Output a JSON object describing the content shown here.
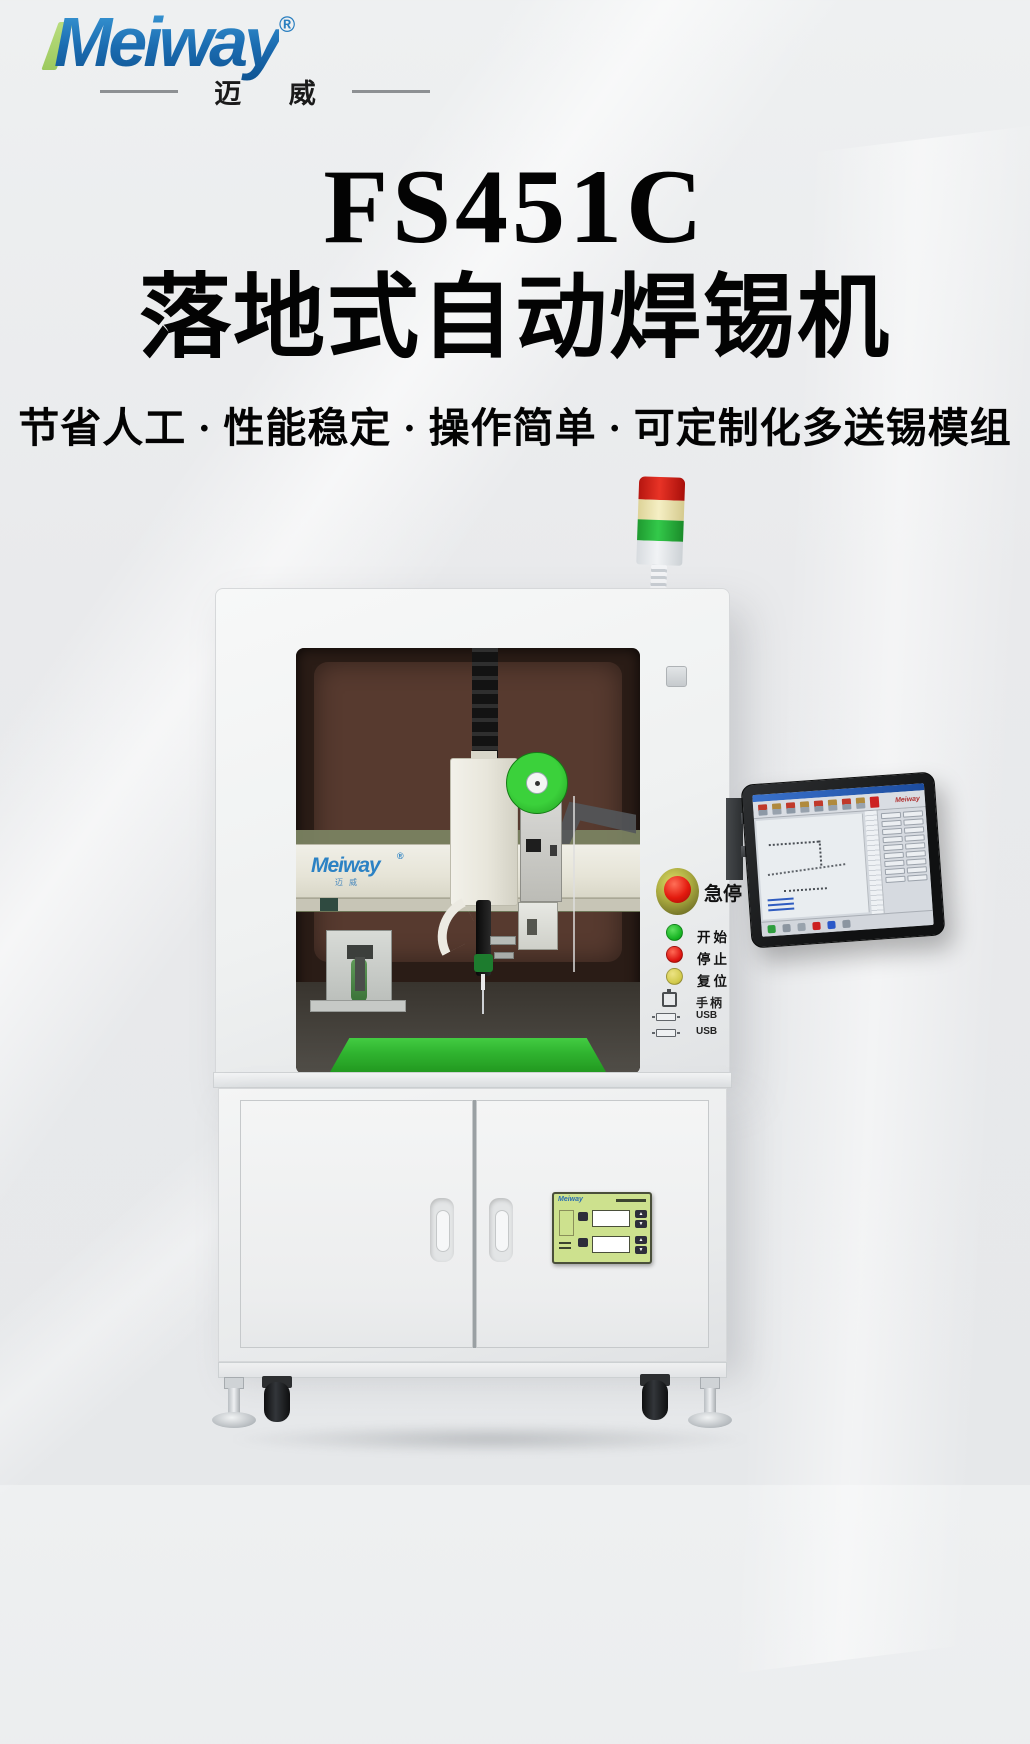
{
  "logo": {
    "brand": "Meiway",
    "reg": "®",
    "cn": "迈 威"
  },
  "title": "FS451C",
  "subtitle": "落地式自动焊锡机",
  "tagline": "节省人工 · 性能稳定 · 操作简单 · 可定制化多送锡模组",
  "machine": {
    "gantry_logo": {
      "brand": "Meiway",
      "reg": "®",
      "cn": "迈威"
    },
    "panel": {
      "estop_label": "急停",
      "buttons": [
        {
          "label": "开始",
          "color": "#17b423"
        },
        {
          "label": "停止",
          "color": "#dd1410"
        },
        {
          "label": "复位",
          "color": "#d2ca4c"
        }
      ],
      "ports": [
        {
          "label": "手柄",
          "type": "handle-connector"
        },
        {
          "label": "USB",
          "type": "usb-port"
        },
        {
          "label": "USB",
          "type": "usb-port"
        }
      ]
    },
    "screen": {
      "brand": "Meiway"
    },
    "temp_panel": {
      "brand": "Meiway"
    },
    "colors": {
      "brand_blue": "#1b6cb1",
      "logo_green": "#9cc95e",
      "platform_green": "#2fb32f",
      "spool_green": "#2db82d",
      "tower_segments": [
        "#e83326",
        "#f5efc4",
        "#33c94a",
        "#e8eaec"
      ],
      "estop_red": "#e31a0e",
      "estop_ring": "#a9a93f",
      "cabinet_body": "#eff1f1",
      "temp_panel_bg": "#cde18e"
    }
  }
}
